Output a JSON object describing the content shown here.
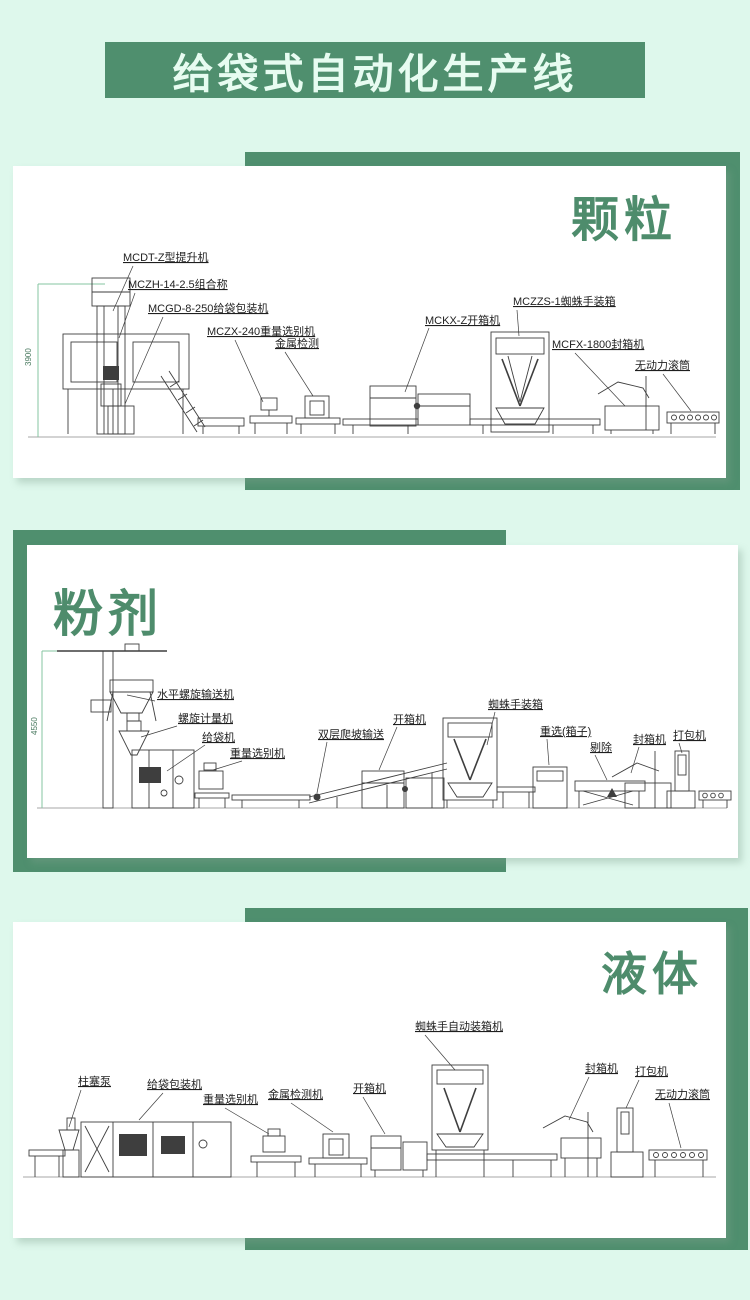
{
  "page": {
    "background": "#def8ec",
    "accent_green": "#4f8f6e",
    "heading_green": "#4e8c6c",
    "card_color": "#ffffff"
  },
  "banner": {
    "title": "给袋式自动化生产线"
  },
  "panels": [
    {
      "id": "granule",
      "heading": "颗粒",
      "dimension": "3900",
      "labels": [
        "MCDT-Z型提升机",
        "MCZH-14-2.5组合称",
        "MCGD-8-250给袋包装机",
        "MCZX-240重量选别机",
        "金属检测",
        "MCKX-Z开箱机",
        "MCZZS-1蜘蛛手装箱",
        "MCFX-1800封箱机",
        "无动力滚筒"
      ]
    },
    {
      "id": "powder",
      "heading": "粉剂",
      "dimension": "4550",
      "labels": [
        "水平螺旋输送机",
        "螺旋计量机",
        "给袋机",
        "重量选别机",
        "双层爬坡输送",
        "开箱机",
        "蜘蛛手装箱",
        "重选(箱子)",
        "剔除",
        "封箱机",
        "打包机"
      ]
    },
    {
      "id": "liquid",
      "heading": "液体",
      "labels": [
        "柱塞泵",
        "给袋包装机",
        "重量选别机",
        "金属检测机",
        "开箱机",
        "蜘蛛手自动装箱机",
        "封箱机",
        "打包机",
        "无动力滚筒"
      ]
    }
  ]
}
